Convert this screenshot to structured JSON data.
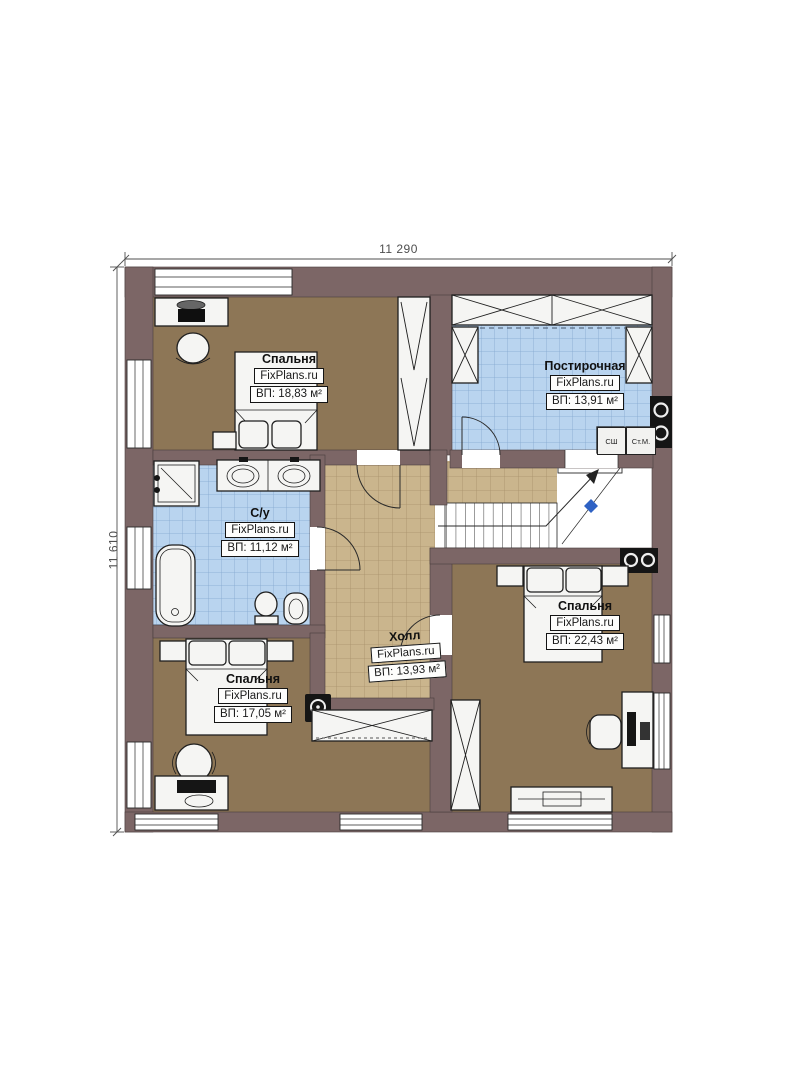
{
  "plan": {
    "width_label": "11 290",
    "height_label": "11 610"
  },
  "rooms": [
    {
      "name": "Спальня",
      "brand": "FixPlans.ru",
      "area": "ВП: 18,83 м²"
    },
    {
      "name": "Постирочная",
      "brand": "FixPlans.ru",
      "area": "ВП: 13,91 м²"
    },
    {
      "name": "С/у",
      "brand": "FixPlans.ru",
      "area": "ВП: 11,12 м²"
    },
    {
      "name": "Холл",
      "brand": "FixPlans.ru",
      "area": "ВП: 13,93 м²"
    },
    {
      "name": "Спальня",
      "brand": "FixPlans.ru",
      "area": "ВП: 22,43 м²"
    },
    {
      "name": "Спальня",
      "brand": "FixPlans.ru",
      "area": "ВП: 17,05 м²"
    }
  ],
  "appliances": {
    "drying_cabinet": "СШ",
    "washing_machine": "Ст.М."
  },
  "colors": {
    "wall": "#7c6666",
    "wall_outline": "#4a3c3c",
    "wood": "#8d7656",
    "tile_blue": "#b9d4ef",
    "tile_blue_line": "#83a7d0",
    "tile_tan": "#cab58d",
    "tile_tan_line": "#a8906a",
    "furniture": "#f5f5f3",
    "outline": "#1f1f1f",
    "dark": "#151515",
    "dim": "#4f4f4f",
    "marker": "#2f62c4"
  }
}
